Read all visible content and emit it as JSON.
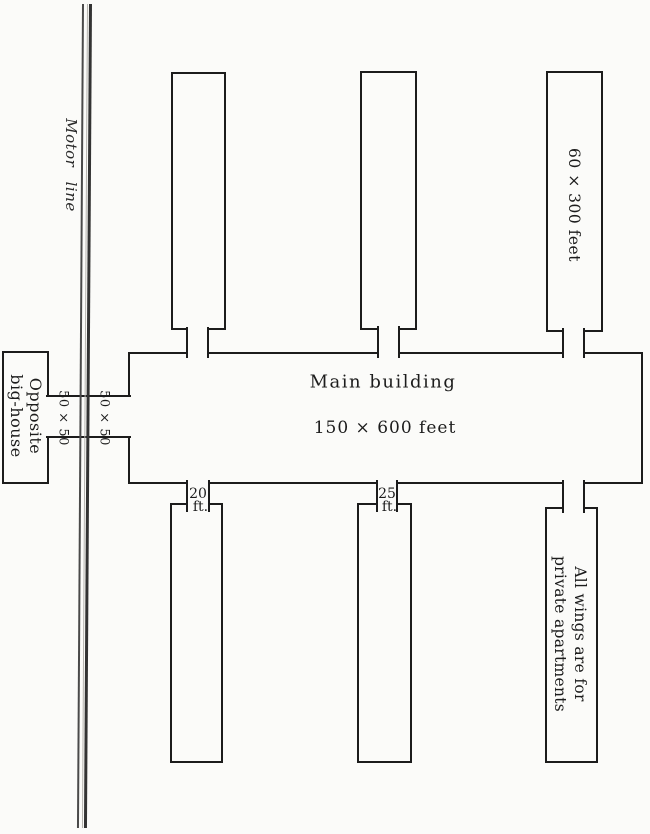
{
  "diagram": {
    "kind": "scanned building floor plan",
    "labels": {
      "motor_line": "Motor line",
      "opposite_house": {
        "line1": "Opposite",
        "line2": "big-house"
      },
      "passage_left": "50 × 50",
      "passage_right": "50 × 50",
      "main_building_name": "Main building",
      "main_building_dims": "150 × 600 feet",
      "top_wing_dims": "60 × 300 feet",
      "wing_note": {
        "line1": "All wings are for",
        "line2": "private apartments"
      },
      "neck_width_1": {
        "value": "20",
        "unit": "ft."
      },
      "neck_width_2": {
        "value": "25",
        "unit": "ft."
      }
    },
    "colors": {
      "ink": "#1c1c1c",
      "track": "#3d3d3d",
      "paper": "#fbfbf9"
    }
  }
}
